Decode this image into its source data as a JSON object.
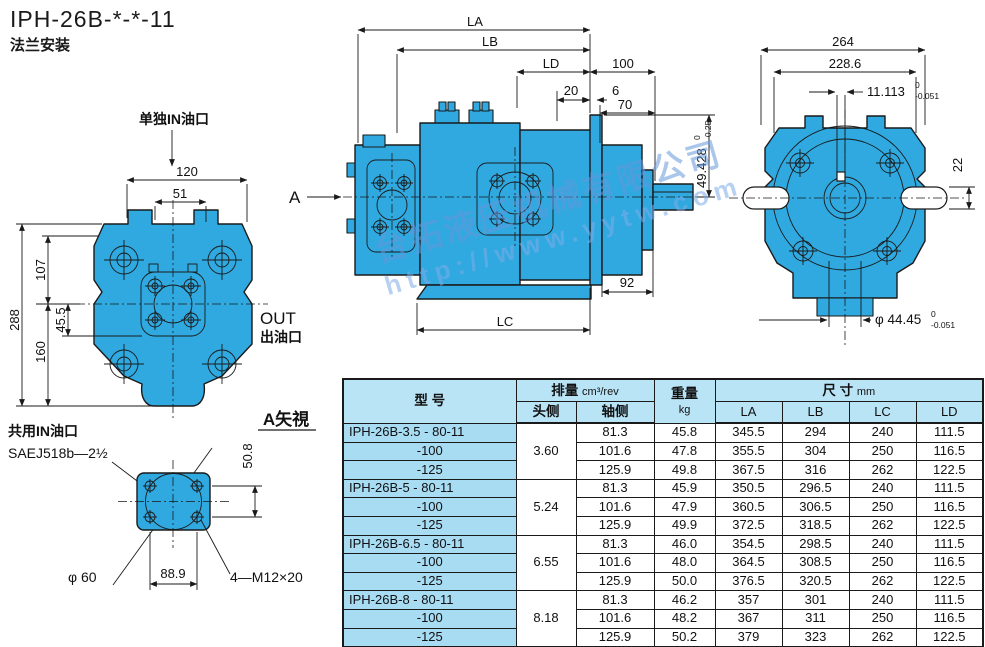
{
  "title": "IPH-26B-*-*-11",
  "subtitle": "法兰安装",
  "colors": {
    "pump_fill": "#2fa9e0",
    "table_header_bg": "#b9e4f6",
    "model_cell_bg": "#a7dcf3",
    "line": "#1a1a1a",
    "watermark": "#7aa8dd"
  },
  "front_view": {
    "port_label": "单独IN油口",
    "out_label": "OUT",
    "out_label_cn": "出油口",
    "dims": {
      "w120": "120",
      "w51": "51",
      "h288": "288",
      "h107": "107",
      "h160": "160",
      "h45": "45.5"
    }
  },
  "a_view": {
    "title": "A矢視",
    "port_label": "共用IN油口",
    "sae_label": "SAEJ518b—2½",
    "dims": {
      "v50": "50.8",
      "dia60": "φ 60",
      "w88": "88.9",
      "bolts": "4—M12×20"
    }
  },
  "side_view": {
    "section_label": "A",
    "dims": {
      "la": "LA",
      "lb": "LB",
      "ld": "LD",
      "d100": "100",
      "d20": "20",
      "d6": "6",
      "d70": "70",
      "d49": "49.428",
      "d49_sup": "0",
      "d49_sub": "-0.25",
      "d92": "92",
      "lc": "LC"
    }
  },
  "rear_view": {
    "dims": {
      "d264": "264",
      "d228": "228.6",
      "d11": "11.113",
      "d11_sup": "0",
      "d11_sub": "-0.051",
      "d22": "22",
      "dia": "φ 44.45",
      "dia_sup": "0",
      "dia_sub": "-0.051"
    }
  },
  "watermark": {
    "line1": "台拓液压机械有限公司",
    "line2": "http://www.yytw.com"
  },
  "table": {
    "headers": {
      "model": "型 号",
      "displacement": "排量",
      "displacement_unit": "cm³/rev",
      "head_side": "头侧",
      "shaft_side": "轴侧",
      "weight": "重量",
      "weight_unit": "kg",
      "size": "尺 寸",
      "size_unit": "mm",
      "la": "LA",
      "lb": "LB",
      "lc": "LC",
      "ld": "LD"
    },
    "groups": [
      {
        "models": [
          "IPH-26B-3.5 - 80-11",
          "-100",
          "-125"
        ],
        "head_side": "3.60",
        "rows": [
          [
            "81.3",
            "45.8",
            "345.5",
            "294",
            "240",
            "111.5"
          ],
          [
            "101.6",
            "47.8",
            "355.5",
            "304",
            "250",
            "116.5"
          ],
          [
            "125.9",
            "49.8",
            "367.5",
            "316",
            "262",
            "122.5"
          ]
        ]
      },
      {
        "models": [
          "IPH-26B-5 - 80-11",
          "-100",
          "-125"
        ],
        "head_side": "5.24",
        "rows": [
          [
            "81.3",
            "45.9",
            "350.5",
            "296.5",
            "240",
            "111.5"
          ],
          [
            "101.6",
            "47.9",
            "360.5",
            "306.5",
            "250",
            "116.5"
          ],
          [
            "125.9",
            "49.9",
            "372.5",
            "318.5",
            "262",
            "122.5"
          ]
        ]
      },
      {
        "models": [
          "IPH-26B-6.5 - 80-11",
          "-100",
          "-125"
        ],
        "head_side": "6.55",
        "rows": [
          [
            "81.3",
            "46.0",
            "354.5",
            "298.5",
            "240",
            "111.5"
          ],
          [
            "101.6",
            "48.0",
            "364.5",
            "308.5",
            "250",
            "116.5"
          ],
          [
            "125.9",
            "50.0",
            "376.5",
            "320.5",
            "262",
            "122.5"
          ]
        ]
      },
      {
        "models": [
          "IPH-26B-8 - 80-11",
          "-100",
          "-125"
        ],
        "head_side": "8.18",
        "rows": [
          [
            "81.3",
            "46.2",
            "357",
            "301",
            "240",
            "111.5"
          ],
          [
            "101.6",
            "48.2",
            "367",
            "311",
            "250",
            "116.5"
          ],
          [
            "125.9",
            "50.2",
            "379",
            "323",
            "262",
            "122.5"
          ]
        ]
      }
    ]
  }
}
